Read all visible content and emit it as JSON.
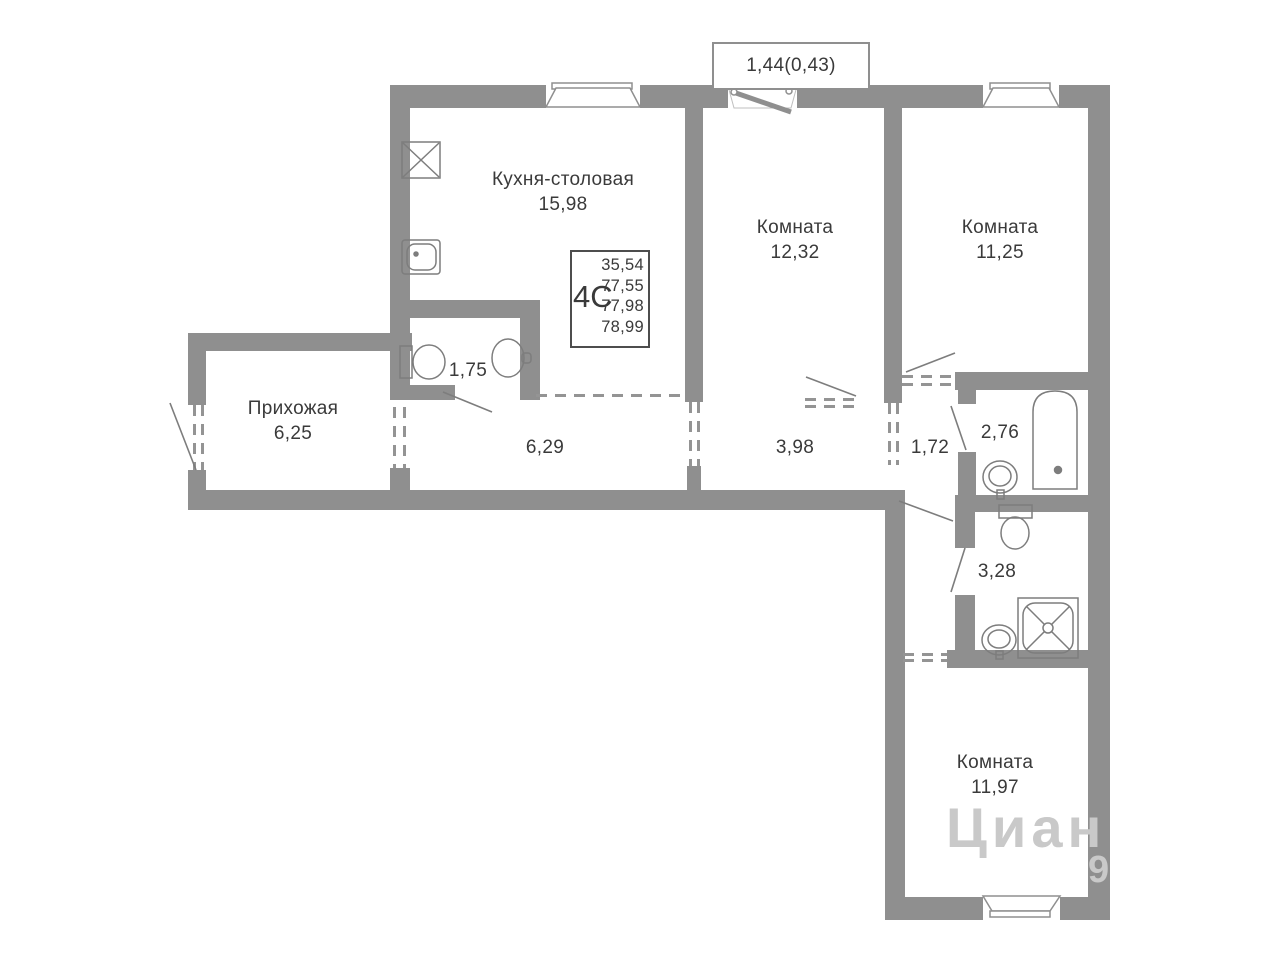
{
  "plan": {
    "type_label": "4С",
    "balcony_label": "1,44(0,43)",
    "info_box": {
      "type": "4С",
      "areas": [
        "35,54",
        "77,55",
        "77,98",
        "78,99"
      ]
    },
    "rooms": {
      "kitchen": {
        "name": "Кухня-столовая",
        "area": "15,98"
      },
      "room_top_left": {
        "name": "Комната",
        "area": "12,32"
      },
      "room_top_right": {
        "name": "Комната",
        "area": "11,25"
      },
      "room_bottom": {
        "name": "Комната",
        "area": "11,97"
      },
      "hallway": {
        "name": "Прихожая",
        "area": "6,25"
      },
      "wc": {
        "area": "1,75"
      },
      "corridor_main": {
        "area": "6,29"
      },
      "corridor_mid": {
        "area": "3,98"
      },
      "corridor_small": {
        "area": "1,72"
      },
      "bathroom": {
        "area": "2,76"
      },
      "shower_room": {
        "area": "3,28"
      }
    },
    "fixtures": [
      "stove",
      "kitchen-sink",
      "toilet",
      "washbasin",
      "bathtub",
      "washbasin",
      "toilet",
      "shower-cabin",
      "washbasin"
    ],
    "colors": {
      "wall": "#8f8f8f",
      "line": "#7d7d7d",
      "text": "#3a3a3a",
      "watermark": "#c9c9c9"
    },
    "watermark": {
      "text": "Циан",
      "digit": "9"
    }
  }
}
